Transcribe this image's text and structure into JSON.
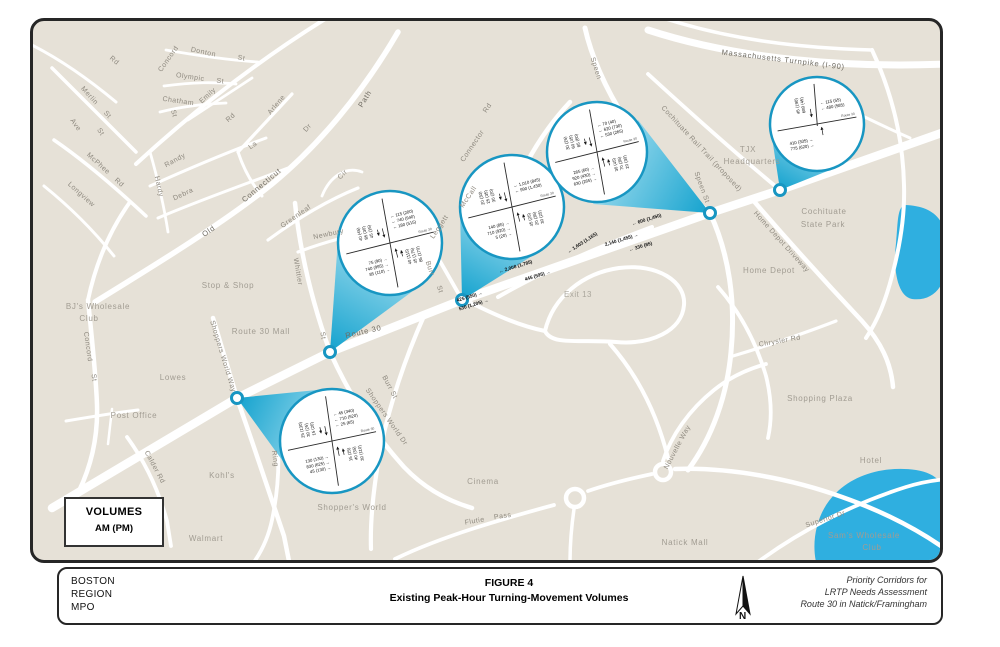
{
  "figure": {
    "org_lines": [
      "BOSTON",
      "REGION",
      "MPO"
    ],
    "title": "FIGURE 4",
    "subtitle": "Existing Peak-Hour Turning-Movement Volumes",
    "credit_lines": [
      "Priority Corridors for",
      "LRTP Needs Assessment",
      "Route 30 in Natick/Framingham"
    ],
    "north_label": "N"
  },
  "legend": {
    "title": "VOLUMES",
    "units": "AM (PM)"
  },
  "colors": {
    "map_bg": "#e6e1d7",
    "road": "#ffffff",
    "water": "#2fafe0",
    "callout_stroke": "#1896c2",
    "cone_dark": "#13a2ce",
    "cone_light": "#a6dff0"
  },
  "map": {
    "labels": [
      {
        "text": "Rd",
        "x": 113,
        "y": 62,
        "rot": 40,
        "cls": "street"
      },
      {
        "text": "Merlin",
        "x": 88,
        "y": 97,
        "rot": 48,
        "cls": "street"
      },
      {
        "text": "St",
        "x": 106,
        "y": 116,
        "rot": 48,
        "cls": "street"
      },
      {
        "text": "Ave",
        "x": 74,
        "y": 126,
        "rot": 55,
        "cls": "street"
      },
      {
        "text": "St",
        "x": 99,
        "y": 133,
        "rot": 55,
        "cls": "street"
      },
      {
        "text": "McPhee",
        "x": 97,
        "y": 165,
        "rot": 42,
        "cls": "street"
      },
      {
        "text": "Rd",
        "x": 118,
        "y": 184,
        "rot": 42,
        "cls": "street"
      },
      {
        "text": "Longview",
        "x": 80,
        "y": 196,
        "rot": 42,
        "cls": "street"
      },
      {
        "text": "Concord",
        "x": 170,
        "y": 60,
        "rot": -55,
        "cls": "street"
      },
      {
        "text": "Donton",
        "x": 203,
        "y": 54,
        "rot": 12,
        "cls": "street"
      },
      {
        "text": "St",
        "x": 241,
        "y": 60,
        "rot": 12,
        "cls": "street"
      },
      {
        "text": "Olympic",
        "x": 190,
        "y": 79,
        "rot": 8,
        "cls": "street"
      },
      {
        "text": "St",
        "x": 220,
        "y": 83,
        "rot": 8,
        "cls": "street"
      },
      {
        "text": "Chatham",
        "x": 178,
        "y": 103,
        "rot": 8,
        "cls": "street"
      },
      {
        "text": "St",
        "x": 172,
        "y": 114,
        "rot": 75,
        "cls": "street"
      },
      {
        "text": "Emily",
        "x": 209,
        "y": 97,
        "rot": -42,
        "cls": "street"
      },
      {
        "text": "Rd",
        "x": 232,
        "y": 119,
        "rot": -42,
        "cls": "street"
      },
      {
        "text": "Arlene",
        "x": 278,
        "y": 106,
        "rot": -50,
        "cls": "street"
      },
      {
        "text": "Dr",
        "x": 309,
        "y": 129,
        "rot": -50,
        "cls": "street"
      },
      {
        "text": "Randy",
        "x": 176,
        "y": 162,
        "rot": -28,
        "cls": "street"
      },
      {
        "text": "La",
        "x": 254,
        "y": 147,
        "rot": -35,
        "cls": "street"
      },
      {
        "text": "Hardy",
        "x": 157,
        "y": 187,
        "rot": 78,
        "cls": "street"
      },
      {
        "text": "Debra",
        "x": 184,
        "y": 196,
        "rot": -25,
        "cls": "street"
      },
      {
        "text": "Connecticut",
        "x": 263,
        "y": 187,
        "rot": -40,
        "cls": "major"
      },
      {
        "text": "Cir",
        "x": 344,
        "y": 176,
        "rot": -45,
        "cls": "street"
      },
      {
        "text": "Greenleaf",
        "x": 297,
        "y": 218,
        "rot": -35,
        "cls": "street"
      },
      {
        "text": "Newbury",
        "x": 329,
        "y": 236,
        "rot": -12,
        "cls": "street"
      },
      {
        "text": "Old",
        "x": 210,
        "y": 233,
        "rot": -35,
        "cls": "major"
      },
      {
        "text": "Path",
        "x": 367,
        "y": 100,
        "rot": -58,
        "cls": "major"
      },
      {
        "text": "Whittier",
        "x": 296,
        "y": 272,
        "rot": 80,
        "cls": "street"
      },
      {
        "text": "St",
        "x": 321,
        "y": 336,
        "rot": 80,
        "cls": "street"
      },
      {
        "text": "Stop & Shop",
        "x": 228,
        "y": 288,
        "rot": 0,
        "cls": "place"
      },
      {
        "text": "BJ's Wholesale",
        "x": 98,
        "y": 309,
        "rot": 0,
        "cls": "place"
      },
      {
        "text": "Club",
        "x": 89,
        "y": 321,
        "rot": 0,
        "cls": "place"
      },
      {
        "text": "Route 30 Mall",
        "x": 261,
        "y": 334,
        "rot": 0,
        "cls": "place"
      },
      {
        "text": "Lowes",
        "x": 173,
        "y": 380,
        "rot": 0,
        "cls": "place"
      },
      {
        "text": "Post Office",
        "x": 134,
        "y": 418,
        "rot": 0,
        "cls": "place"
      },
      {
        "text": "Concord",
        "x": 86,
        "y": 347,
        "rot": 82,
        "cls": "street"
      },
      {
        "text": "St",
        "x": 92,
        "y": 378,
        "rot": 82,
        "cls": "street"
      },
      {
        "text": "Calder Rd",
        "x": 153,
        "y": 468,
        "rot": 62,
        "cls": "street"
      },
      {
        "text": "Kohl's",
        "x": 222,
        "y": 478,
        "rot": 0,
        "cls": "place"
      },
      {
        "text": "Walmart",
        "x": 206,
        "y": 541,
        "rot": 0,
        "cls": "place"
      },
      {
        "text": "Ring",
        "x": 273,
        "y": 459,
        "rot": 82,
        "cls": "street"
      },
      {
        "text": "Shoppers World Way",
        "x": 221,
        "y": 357,
        "rot": 73,
        "cls": "street"
      },
      {
        "text": "Shoppers World Dr",
        "x": 385,
        "y": 418,
        "rot": 55,
        "cls": "street"
      },
      {
        "text": "Shopper's World",
        "x": 352,
        "y": 510,
        "rot": 0,
        "cls": "place"
      },
      {
        "text": "Burr St",
        "x": 388,
        "y": 388,
        "rot": 62,
        "cls": "street"
      },
      {
        "text": "Burr",
        "x": 428,
        "y": 269,
        "rot": 72,
        "cls": "street"
      },
      {
        "text": "St",
        "x": 438,
        "y": 290,
        "rot": 72,
        "cls": "street"
      },
      {
        "text": "Route 30",
        "x": 364,
        "y": 334,
        "rot": -13,
        "cls": "major"
      },
      {
        "text": "Leggett",
        "x": 441,
        "y": 228,
        "rot": -56,
        "cls": "street"
      },
      {
        "text": "McCall",
        "x": 470,
        "y": 198,
        "rot": -56,
        "cls": "street"
      },
      {
        "text": "Connector",
        "x": 474,
        "y": 147,
        "rot": -56,
        "cls": "street"
      },
      {
        "text": "Rd",
        "x": 489,
        "y": 109,
        "rot": -56,
        "cls": "street"
      },
      {
        "text": "Exit 13",
        "x": 578,
        "y": 297,
        "rot": 0,
        "cls": "exit"
      },
      {
        "text": "Speen",
        "x": 594,
        "y": 69,
        "rot": 72,
        "cls": "street"
      },
      {
        "text": "Speen St",
        "x": 700,
        "y": 188,
        "rot": 70,
        "cls": "street"
      },
      {
        "text": "Cochituate Rail Trail (proposed)",
        "x": 700,
        "y": 150,
        "rot": 47,
        "cls": "street"
      },
      {
        "text": "Massachusetts Turnpike (I-90)",
        "x": 783,
        "y": 62,
        "rot": 7,
        "cls": "major"
      },
      {
        "text": "TJX",
        "x": 748,
        "y": 152,
        "rot": 0,
        "cls": "place"
      },
      {
        "text": "Headquarters",
        "x": 752,
        "y": 164,
        "rot": 0,
        "cls": "place"
      },
      {
        "text": "Home Depot Driveway",
        "x": 780,
        "y": 243,
        "rot": 48,
        "cls": "street"
      },
      {
        "text": "Cochituate",
        "x": 824,
        "y": 214,
        "rot": 0,
        "cls": "place"
      },
      {
        "text": "State Park",
        "x": 823,
        "y": 227,
        "rot": 0,
        "cls": "place"
      },
      {
        "text": "Home Depot",
        "x": 769,
        "y": 273,
        "rot": 0,
        "cls": "place"
      },
      {
        "text": "Chrysler Rd",
        "x": 780,
        "y": 343,
        "rot": -10,
        "cls": "street"
      },
      {
        "text": "Shopping Plaza",
        "x": 820,
        "y": 401,
        "rot": 0,
        "cls": "place"
      },
      {
        "text": "Natick Mall",
        "x": 685,
        "y": 545,
        "rot": 0,
        "cls": "place"
      },
      {
        "text": "Flutie",
        "x": 475,
        "y": 523,
        "rot": -10,
        "cls": "street"
      },
      {
        "text": "Pass",
        "x": 503,
        "y": 518,
        "rot": -8,
        "cls": "street"
      },
      {
        "text": "Cinema",
        "x": 483,
        "y": 484,
        "rot": 0,
        "cls": "place"
      },
      {
        "text": "Nouvelle Way",
        "x": 679,
        "y": 448,
        "rot": -62,
        "cls": "street"
      },
      {
        "text": "Superior Dr",
        "x": 826,
        "y": 521,
        "rot": -18,
        "cls": "street"
      },
      {
        "text": "Hotel",
        "x": 871,
        "y": 463,
        "rot": 0,
        "cls": "place"
      },
      {
        "text": "Sam's Wholesale",
        "x": 864,
        "y": 538,
        "rot": 0,
        "cls": "place"
      },
      {
        "text": "Club",
        "x": 872,
        "y": 550,
        "rot": 0,
        "cls": "place"
      }
    ],
    "flow_labels": [
      {
        "text": "2,008 (1,785)",
        "dir": "left",
        "x": 516,
        "y": 268,
        "rot": -17
      },
      {
        "text": "445 (595)",
        "dir": "right",
        "x": 538,
        "y": 277,
        "rot": -17
      },
      {
        "text": "1,603 (1,165)",
        "dir": "left",
        "x": 583,
        "y": 244,
        "rot": -33
      },
      {
        "text": "330 (85)",
        "dir": "left",
        "x": 641,
        "y": 248,
        "rot": -17
      },
      {
        "text": "600 (1,450)",
        "dir": "left",
        "x": 647,
        "y": 221,
        "rot": -17
      },
      {
        "text": "2,140 (1,455)",
        "dir": "right",
        "x": 622,
        "y": 241,
        "rot": -17
      },
      {
        "text": "425 (550)",
        "dir": "right",
        "x": 470,
        "y": 298,
        "rot": -17
      },
      {
        "text": "530 (1,205)",
        "dir": "right",
        "x": 474,
        "y": 306,
        "rot": -17
      }
    ],
    "callouts": [
      {
        "name": "route30-shoppers-world-way",
        "cx": 332,
        "cy": 441,
        "r": 52,
        "angle": -12,
        "type": "cross",
        "marker": {
          "x": 237,
          "y": 398
        },
        "cone": "237,398 327,389 290,471",
        "top_right": [
          "45 (340)",
          "710 (520)",
          "25 (65)"
        ],
        "bottom_left": [
          "130 (130)",
          "830 (625)",
          "45 (130)"
        ],
        "left_col": [
          "25 (130)",
          "30 (25)",
          "15 (20)"
        ],
        "right_col": [
          "15 (25)",
          "40 (35)",
          "30 (110)"
        ],
        "road_label": "Route 30"
      },
      {
        "name": "route30-whittier-st",
        "cx": 390,
        "cy": 243,
        "r": 52,
        "angle": -14,
        "type": "cross",
        "marker": {
          "x": 330,
          "y": 352
        },
        "cone": "330,352 421,285 338,239",
        "top_right": [
          "115 (200)",
          "740 (940)",
          "180 (515)"
        ],
        "bottom_left": [
          "75 (90)",
          "740 (995)",
          "85 (110)"
        ],
        "left_col": [
          "40 (45)",
          "85 (30)",
          "45 (15)"
        ],
        "right_col": [
          "40 (115)",
          "45 (175)",
          "85 (170)"
        ],
        "road_label": "Route 30"
      },
      {
        "name": "route30-leggett-mccall-connector",
        "cx": 512,
        "cy": 207,
        "r": 52,
        "angle": -14,
        "type": "cross",
        "marker": {
          "x": 462,
          "y": 300
        },
        "cone": "462,300 540,251 460,208",
        "top_right": [
          "1,010 (845)",
          "990 (1,430)"
        ],
        "bottom_left": [
          "140 (85)",
          "710 (920)",
          "5 (20)"
        ],
        "left_col": [
          "20 (30)",
          "25 (35)",
          "30 (20)"
        ],
        "right_col": [
          "45 (25)",
          "20 (35)",
          "30 (25)"
        ],
        "road_label": "Route 30"
      },
      {
        "name": "route30-speen-st",
        "cx": 597,
        "cy": 152,
        "r": 50,
        "angle": -14,
        "type": "cross",
        "marker": {
          "x": 710,
          "y": 213
        },
        "cone": "710,213 638,120 593,204",
        "top_right": [
          "70 (40)",
          "620 (730)",
          "530 (265)"
        ],
        "bottom_left": [
          "265 (60)",
          "920 (430)",
          "630 (265)"
        ],
        "left_col": [
          "30 (25)",
          "60 (45)",
          "85 (60)"
        ],
        "right_col": [
          "30 (45)",
          "70 (35)",
          "20 (30)"
        ],
        "road_label": "Route 30"
      },
      {
        "name": "route30-home-depot-driveway",
        "cx": 817,
        "cy": 124,
        "r": 47,
        "angle": -10,
        "type": "tee",
        "marker": {
          "x": 780,
          "y": 190
        },
        "cone": "780,190 835,168 771,131",
        "top_right": [
          "115 (55)",
          "480 (585)"
        ],
        "bottom_left": [
          "410 (305)",
          "775 (620)"
        ],
        "left_col": [
          "45 (190)",
          "680 (45)"
        ],
        "right_col": [],
        "road_label": "Route 30"
      }
    ]
  }
}
